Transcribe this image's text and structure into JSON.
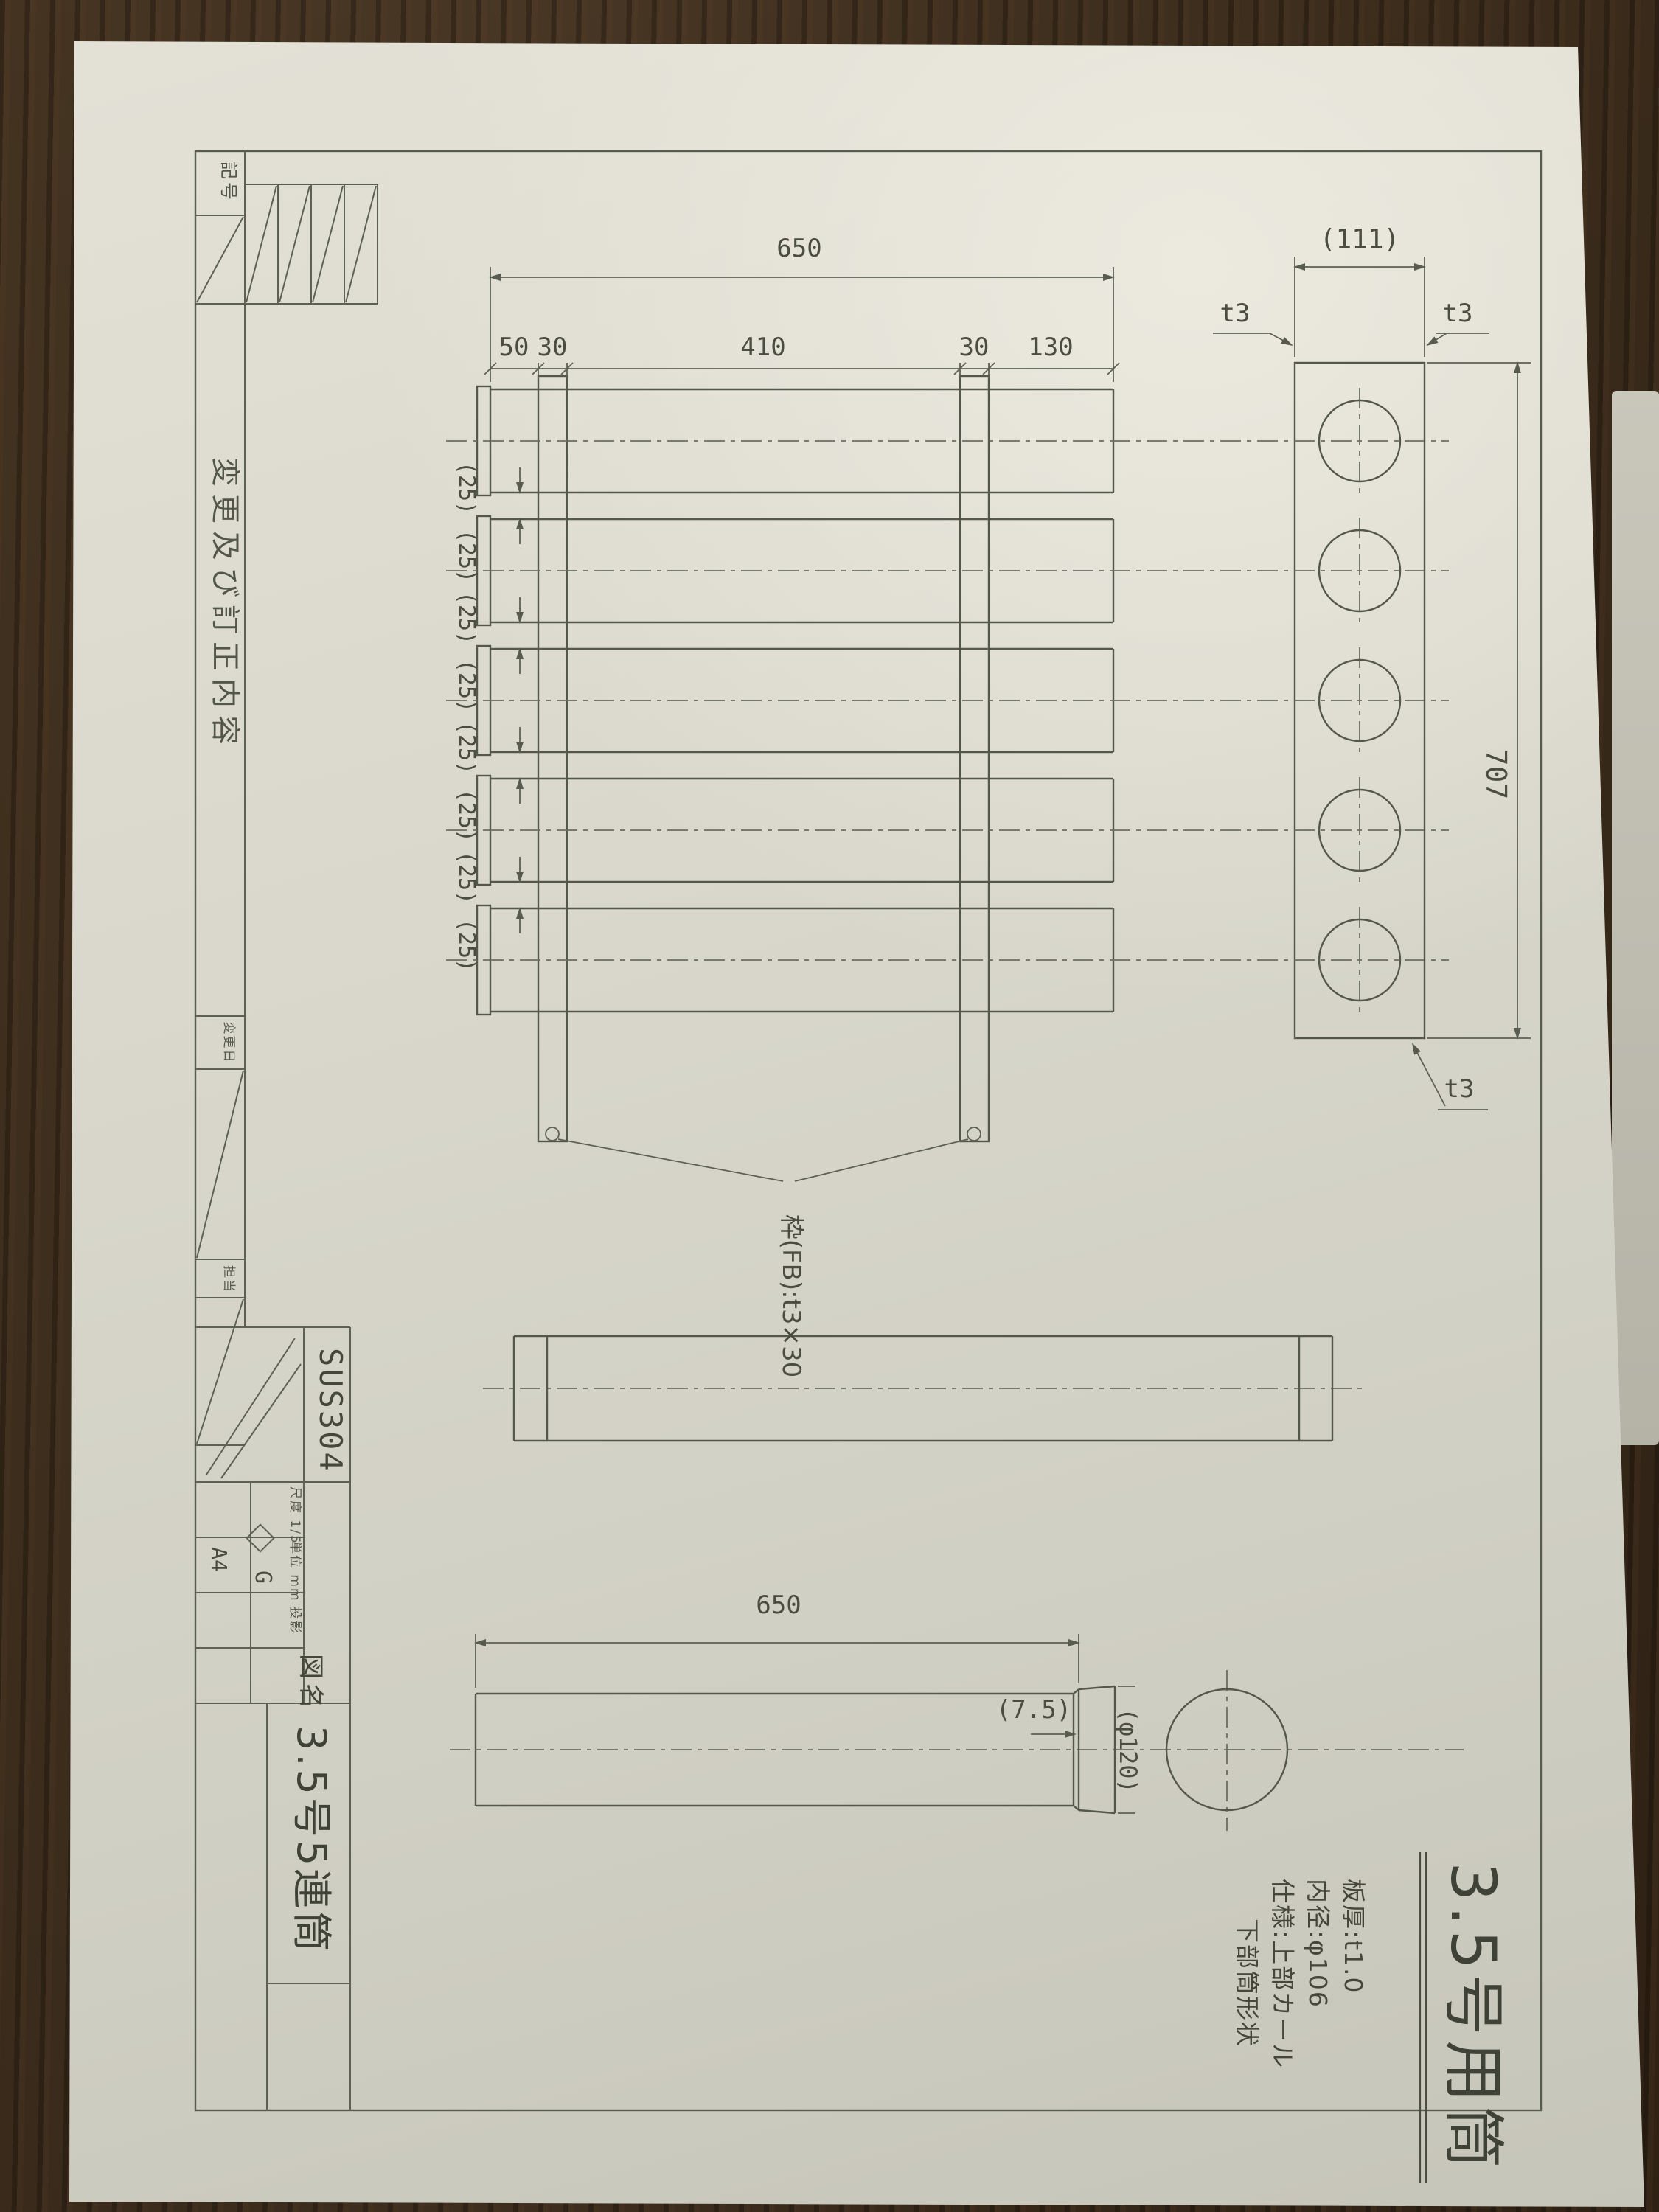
{
  "notes": {
    "title": "3.5号用筒",
    "spec_thickness": "板厚:t1.0",
    "spec_inner_dia": "内径:φ106",
    "spec_upper": "仕様:上部カール",
    "spec_lower": "下部筒形状"
  },
  "dims": {
    "total_length": "650",
    "seg_50": "50",
    "seg_30a": "30",
    "seg_410": "410",
    "seg_30b": "30",
    "seg_130": "130",
    "depth": "(111)",
    "t3": "t3",
    "overall_length": "707",
    "gap": "(25)",
    "frame_note": "枠(FB):t3×30",
    "detail_length": "650",
    "flare_lip": "(7.5)",
    "flare_dia": "(φ120)"
  },
  "revision_strip": {
    "symbol": "記号",
    "content": "変更及び訂正内容",
    "date": "変更日",
    "person": "担当"
  },
  "title_block": {
    "material": "SUS304",
    "sheet_size": "A4",
    "logo": "G",
    "row_scale": "尺度 1/5",
    "row_unit": "単位 mm",
    "row_proj": "投影",
    "name_label": "図名",
    "drawing_name": "3.5号5連筒"
  }
}
